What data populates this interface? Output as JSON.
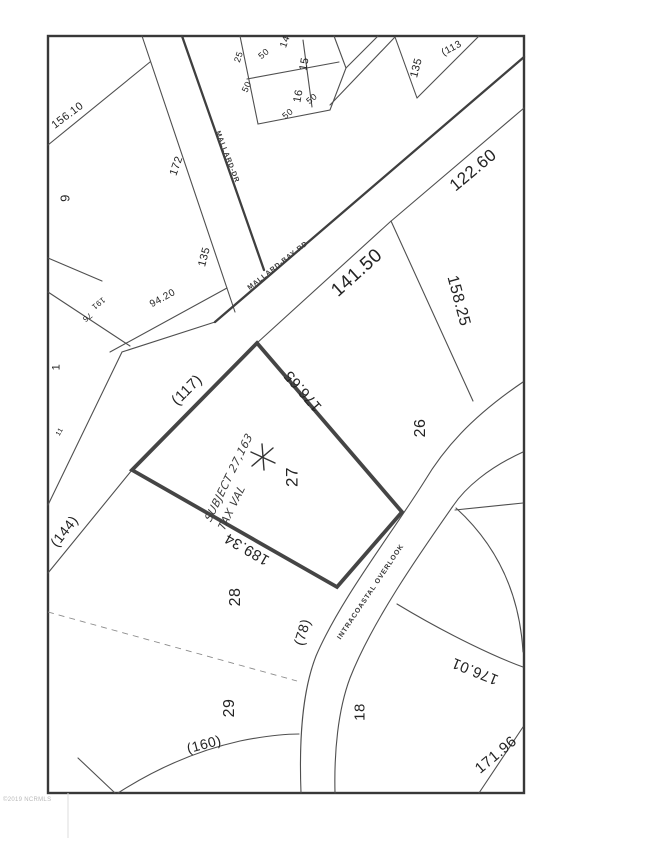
{
  "map_type": "plat-survey-map",
  "watermark": "©2019 NCRMLS",
  "roads": {
    "mallard_dr": "MALLARD-DR",
    "mallard_bay_rd": "MALLARD-BAY-RD",
    "intracoastal_overlook": "INTRACOASTAL OVERLOOK"
  },
  "lot_numbers": {
    "l1": "1",
    "l9": "9",
    "l14": "14",
    "l15": "15",
    "l16": "16",
    "l18": "18",
    "l26": "26",
    "l27": "27",
    "l28": "28",
    "l29": "29"
  },
  "dimensions": {
    "d156_10": "156.10",
    "d172": "172",
    "d135_w": "135",
    "d94_20": "94.20",
    "d191": "191",
    "d76": "76",
    "d11": "11",
    "d25": "25",
    "d50a": "50",
    "d50b": "50",
    "d50c": "50",
    "d50d": "50",
    "d113": "(113",
    "d135_e": "135",
    "d122_60": "122.60",
    "d141_50": "141.50",
    "d158_25": "158.25",
    "d176_65": "176.65",
    "d117": "(117)",
    "d144": "(144)",
    "d189_34": "189.34",
    "d78": "(78)",
    "d160": "(160)",
    "d176_01": "176.01",
    "d171_96": "171.96"
  },
  "annotation": {
    "line1": "SUBJECT 27,163",
    "line2": "TAX VAL",
    "marker": "hand-drawn-asterisk"
  },
  "colors": {
    "line": "#4f4f4f",
    "bold_line": "#3f3f3f",
    "subject_outline": "#454545",
    "text": "#232323",
    "watermark_text": "#b9b9b9",
    "background": "#ffffff"
  }
}
